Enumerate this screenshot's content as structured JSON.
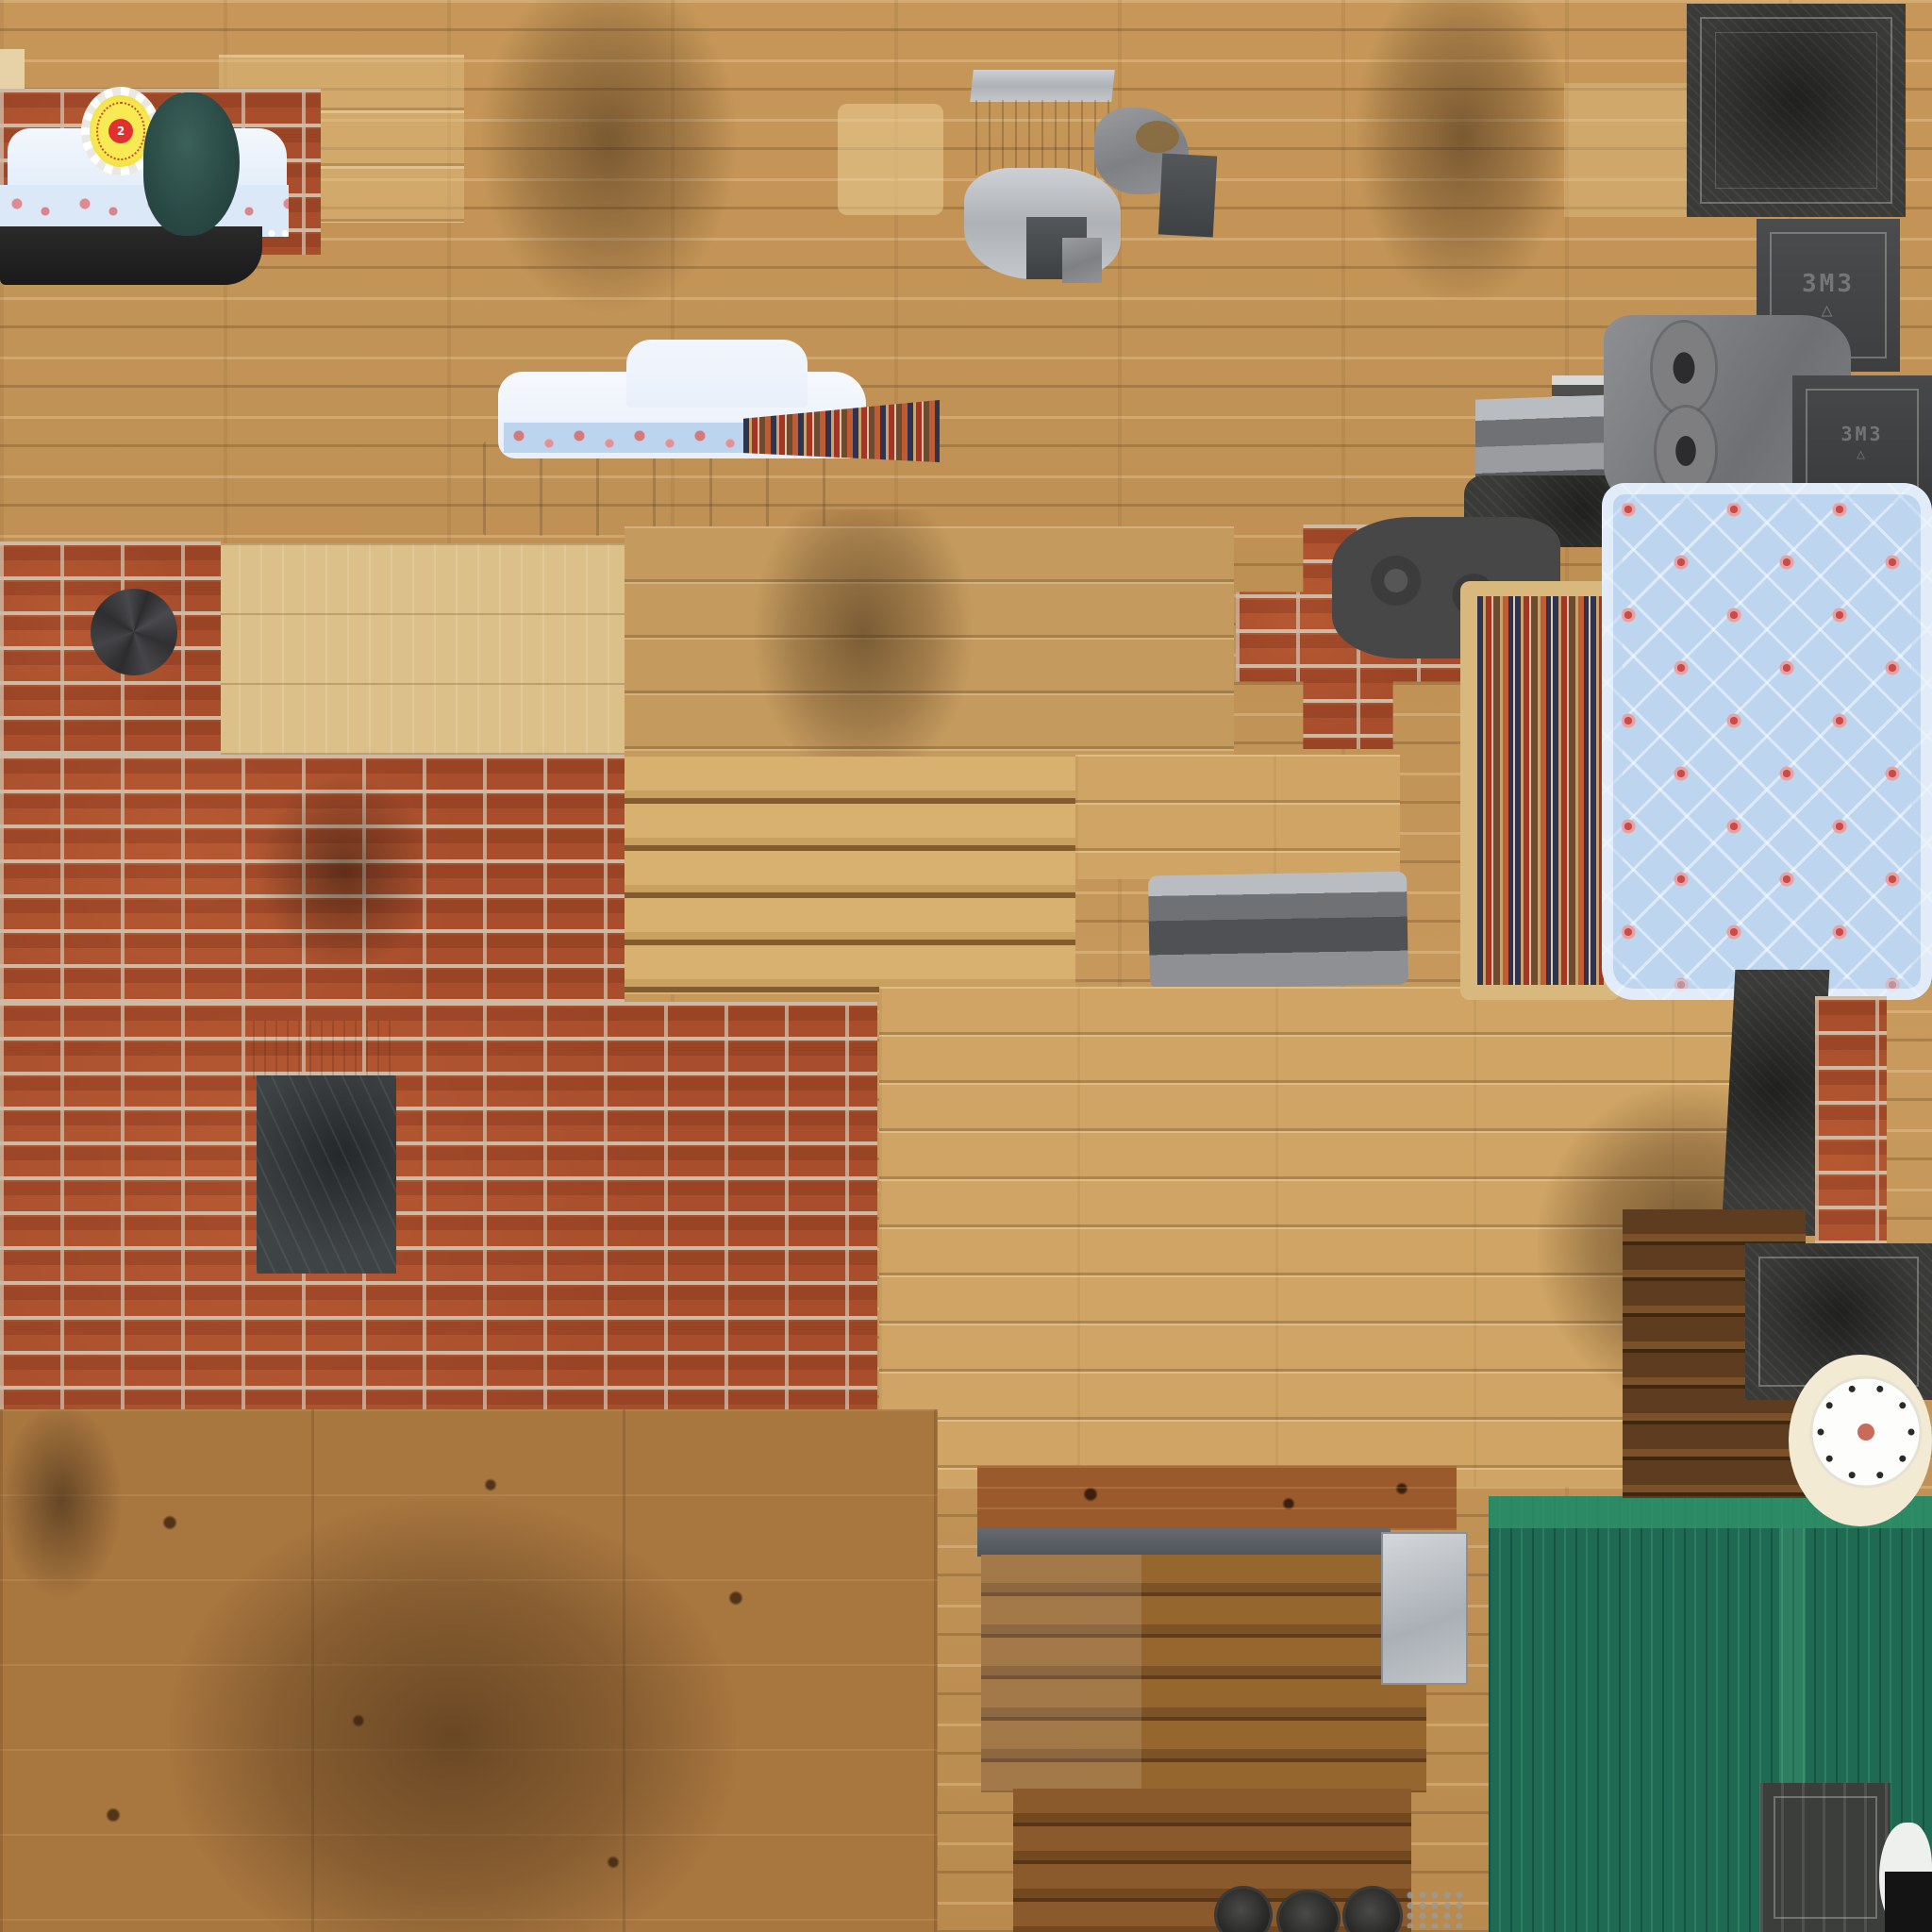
{
  "crate": {
    "stencil_top": "3M3",
    "triangle_top": "△",
    "stencil_side": "3M3",
    "triangle_side": "△"
  },
  "rosette": {
    "center_mark": "2"
  },
  "palette": {
    "wood-base": "#c2945a",
    "wood-pale": "#dcc08a",
    "wood-floor": "#cfa464",
    "wood-red": "#9b5a2b",
    "plywood": "#a8763f",
    "brick": "#a84e2c",
    "mortar": "#cdbaa5",
    "charcoal": "#3a3a38",
    "quilt-blue": "#bed5f0",
    "rose-red": "#c84b4b",
    "rug-tan": "#d8b87c",
    "green-roof": "#1e6a52",
    "green-light": "#2f8f68",
    "lace-blue": "#dbe8f7",
    "stencil": "#9aa09a"
  },
  "atlas_contents": [
    {
      "name": "wood-log-wall",
      "description": "tan horizontal log/plank wall texture covering most of the sheet, with sooty dark smudges"
    },
    {
      "name": "red-brick-wall",
      "description": "large red brick wall section on the left middle with mortar joints"
    },
    {
      "name": "pine-board-panel",
      "description": "pale pine plank panel beside the brick wall"
    },
    {
      "name": "wooden-staircase",
      "description": "stair steps texture in the center"
    },
    {
      "name": "plank-floor",
      "description": "wide light plank floor area center-right"
    },
    {
      "name": "plywood-wall",
      "description": "dark stained plywood sheet bottom-left with knots"
    },
    {
      "name": "award-rosette",
      "description": "yellow prize rosette with white ruffle, red dotted ring and red center"
    },
    {
      "name": "knit-hat",
      "description": "dark teal rounded blob (hat/fabric piece) top-left"
    },
    {
      "name": "lace-bed-set",
      "description": "white and pale blue lace bed valance with pink floral trim and black base, top-left"
    },
    {
      "name": "floral-bed-set",
      "description": "white duvet with blue floral border band on gray metal bunk base, upper middle"
    },
    {
      "name": "striped-runner",
      "description": "small striped woven runner wedge beside the bed"
    },
    {
      "name": "rag-rug",
      "description": "long vertical rag rug with navy, red, orange and tan stripes and tan fringe border"
    },
    {
      "name": "rose-quilt",
      "description": "light blue quilt with diamond quilting and pink rose clusters, ruffled edge"
    },
    {
      "name": "metal-table-parts",
      "description": "gray metal slab, brown shelf board and metal leg fragments top-center"
    },
    {
      "name": "ammo-crate-lid",
      "description": "dark charcoal crate lid with double inset frame, top-right"
    },
    {
      "name": "ammo-crate-side",
      "description": "crate side panel with stenciled 3M3 marking and triangle"
    },
    {
      "name": "cast-iron-stove-parts",
      "description": "gray stove body with two round burner discs and striped grate"
    },
    {
      "name": "brick-chimney-patch",
      "description": "cross-shaped brick chimney fragment with dark cast-iron top pieces"
    },
    {
      "name": "stovepipe-cap",
      "description": "dark radial metal cap mounted on the brick wall"
    },
    {
      "name": "soot-shield-plate",
      "description": "dark scratched metal sheet with light top band on the brick wall"
    },
    {
      "name": "metal-trough",
      "description": "gray sheet-metal channel piece in the middle"
    },
    {
      "name": "dark-plank-cabinet",
      "description": "stack of dark brown slats (drawers) right of the floor planks"
    },
    {
      "name": "brick-column",
      "description": "narrow red brick column at the right edge"
    },
    {
      "name": "metal-crate",
      "description": "dark metal crate with frame at the right edge"
    },
    {
      "name": "clock-face",
      "description": "white disc with ring of black dots and small red center"
    },
    {
      "name": "corrugated-green-roof",
      "description": "teal-green corrugated metal roofing in the bottom-right corner"
    },
    {
      "name": "ribbed-crate",
      "description": "small dark ribbed crate sitting on the green roofing"
    },
    {
      "name": "chest-of-drawers",
      "description": "reddish-brown plank furniture faces bottom-center with slate gray bar"
    },
    {
      "name": "galvanized-box",
      "description": "small light gray galvanized box bottom-center"
    },
    {
      "name": "stove-burner-plates",
      "description": "dark round burner plates with chain links at the bottom edge"
    }
  ]
}
